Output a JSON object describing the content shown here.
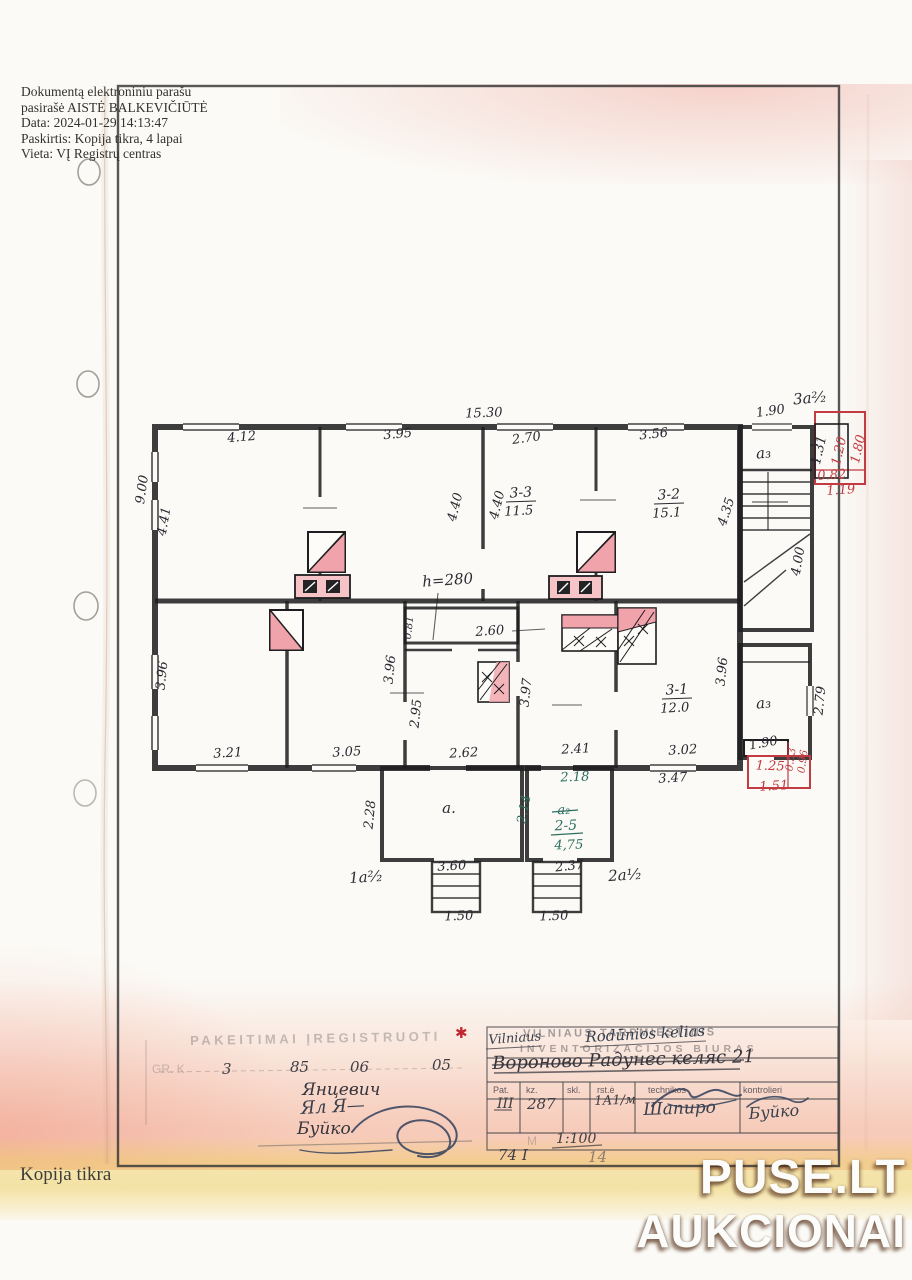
{
  "signature_block": {
    "lines": [
      "Dokumentą elektroniniu parašu",
      "pasirašė AISTĖ BALKEVIČIŪTĖ",
      "Data: 2024-01-29 14:13:47",
      "Paskirtis: Kopija tikra, 4 lapai",
      "Vieta: VĮ Registrų centras"
    ]
  },
  "plan": {
    "dims": [
      "15.30",
      "1.90",
      "3a²⁄₂",
      "4.12",
      "3.95",
      "2.70",
      "3.56",
      "4.41",
      "9.00",
      "4.40",
      "4.40",
      "4.35",
      "h=280",
      "1.31",
      "1.20",
      "1.80",
      "0.82",
      "1.19",
      "4.00",
      "0.81",
      "2.60",
      "3.96",
      "3.96",
      "3.96",
      "2.95",
      "3.97",
      "2.79",
      "3.21",
      "3.05",
      "2.62",
      "2.41",
      "3.02",
      "3.47",
      "2.18",
      "1.90",
      "1.25",
      "1.51",
      "0.53",
      "0.96",
      "2.28",
      "2.14",
      "3.60",
      "2.37",
      "1.50",
      "1.50",
      "1a²⁄₂",
      "2a¹⁄₂",
      "a.",
      "a₃",
      "a₃"
    ],
    "rooms": {
      "r33": {
        "id": "3-3",
        "area": "11.5"
      },
      "r32": {
        "id": "3-2",
        "area": "15.1"
      },
      "r31": {
        "id": "3-1",
        "area": "12.0"
      },
      "r25": {
        "id": "2-5",
        "area": "4,75",
        "old_id": "a₂"
      }
    }
  },
  "stamp": {
    "title_faded": "PAKEITIMAI ĮREGISTRUOTI",
    "ledger_prefix": "GR. K",
    "ledger_values": [
      "3",
      "85",
      "06",
      "05"
    ],
    "asterisk": "✱",
    "surname_typed": "Янцевич",
    "surname_script": "Ял Я—",
    "surname_controller": "Буйко"
  },
  "bureau": {
    "header_line1": "VILNIAUS TARPMIESTINIS",
    "header_line2": "INVENTORIZACIJOS BIURAS",
    "hw_city": "Vilniaus",
    "hw_street": "Rodūnios kelias",
    "address_crossed_out": "Вороново Радунес келяс 21",
    "columns": [
      "Pat.",
      "kz.",
      "skl.",
      "rst.ė",
      "technikos",
      "kontrolieri"
    ],
    "row_values": [
      "III",
      "287",
      "1А1/м",
      "Шапиро",
      "Буйко"
    ],
    "scale_prefix": "М",
    "scale": "1:100",
    "doc_no": "74 I",
    "doc_no2": "14"
  },
  "watermark": {
    "line1": "PUSE.LT",
    "line2": "AUKCIONAI"
  },
  "footer": {
    "copy_note": "Kopija tikra"
  },
  "colors": {
    "red_annotation": "#c23b42",
    "green_annotation": "#2d6e60",
    "ink": "#2a2830",
    "blue_ink": "#31405c",
    "stove_pink": "#f0a3aa",
    "salmon_tint": "#f2a98d",
    "yellow_tint": "#eed36e"
  }
}
